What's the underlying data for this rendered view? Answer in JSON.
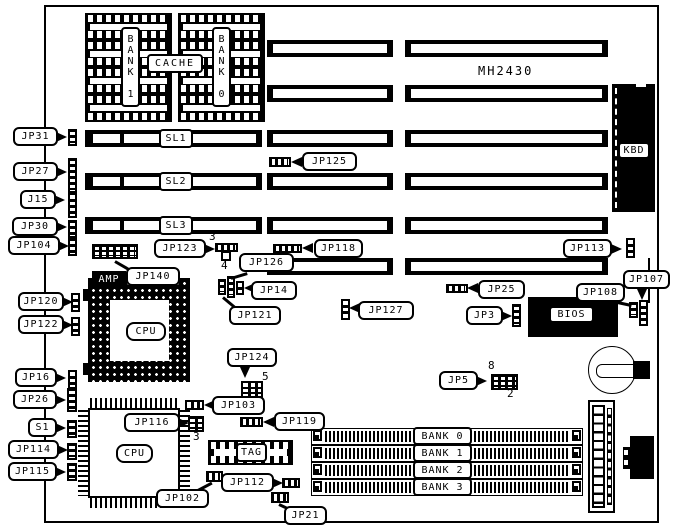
{
  "board": {
    "model": "MH2430"
  },
  "cache": {
    "bank1_label": "BANK 1",
    "bank0_label": "BANK 0",
    "cache_label": "CACHE"
  },
  "slot_labels": {
    "sl1": "SL1",
    "sl2": "SL2",
    "sl3": "SL3"
  },
  "chips": {
    "kbd": "KBD",
    "bios": "BIOS",
    "cpu_socket": "CPU",
    "cpu_chip": "CPU",
    "tag": "TAG",
    "amp": "AMP"
  },
  "simm_banks": {
    "bank0": "BANK 0",
    "bank1": "BANK 1",
    "bank2": "BANK 2",
    "bank3": "BANK 3"
  },
  "callouts": {
    "jp31": "JP31",
    "jp27": "JP27",
    "j15": "J15",
    "jp30": "JP30",
    "jp104": "JP104",
    "jp120": "JP120",
    "jp122": "JP122",
    "jp16": "JP16",
    "jp26": "JP26",
    "s1": "S1",
    "jp114": "JP114",
    "jp115": "JP115",
    "jp125": "JP125",
    "jp123": "JP123",
    "jp118": "JP118",
    "jp113": "JP113",
    "jp126": "JP126",
    "jp140": "JP140",
    "jp14": "JP14",
    "jp121": "JP121",
    "jp127": "JP127",
    "jp25": "JP25",
    "jp3": "JP3",
    "jp108": "JP108",
    "jp107": "JP107",
    "jp124": "JP124",
    "jp5": "JP5",
    "jp103": "JP103",
    "jp116": "JP116",
    "jp119": "JP119",
    "jp112": "JP112",
    "jp102": "JP102",
    "jp21": "JP21"
  },
  "pin_numbers": {
    "jp123_top": "3",
    "jp123_bottom": "4",
    "jp124_pin5": "5",
    "jp116_pin3": "3",
    "jp5_pin8": "8",
    "jp5_pin2": "2"
  }
}
